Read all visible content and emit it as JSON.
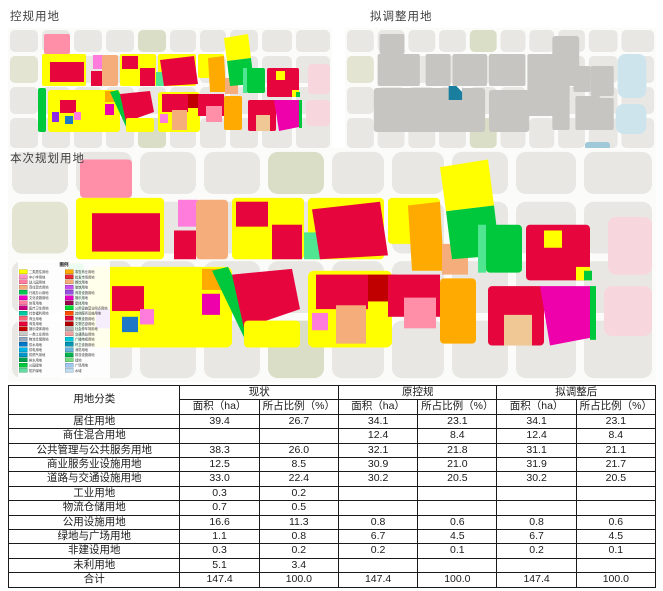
{
  "maps": {
    "control_plan": {
      "title": "控规用地"
    },
    "proposed_adjust": {
      "title": "拟调整用地"
    },
    "current_plan": {
      "title": "本次规划用地"
    }
  },
  "palette": {
    "yellow": "#ffff00",
    "red": "#e6053c",
    "darkred": "#c00000",
    "green": "#00c83c",
    "mint": "#50e691",
    "orange": "#ffaa00",
    "salmon": "#f5ae7b",
    "pink": "#ff8fa8",
    "magenta": "#ee00aa",
    "brightpink": "#ff7bdc",
    "violet": "#8c28e6",
    "blue": "#1e78c8",
    "teal": "#1a7f9e",
    "tan": "#f0c896",
    "palepink": "#f8d6de",
    "grayblock": "#e8e7e4",
    "olive": "#dbdec6",
    "olivelight": "#e3e4d2",
    "darkgray": "#c6c5c1",
    "water": "#cde4ec",
    "darkwater": "#9fc8d8",
    "street": "#fbfbf9"
  },
  "legend": {
    "title": "图例",
    "columns": [
      [
        {
          "color": "#ffff00",
          "label": "二类居住用地"
        },
        {
          "color": "#ff96c8",
          "label": "中小学用地"
        },
        {
          "color": "#ff7da0",
          "label": "幼儿园用地"
        },
        {
          "color": "#f5ae7b",
          "label": "商住混合用地"
        },
        {
          "color": "#00c850",
          "label": "行政办公用地"
        },
        {
          "color": "#f000c8",
          "label": "文化设施用地"
        },
        {
          "color": "#ff7da0",
          "label": "体育用地"
        },
        {
          "color": "#c80082",
          "label": "医疗卫生用地"
        },
        {
          "color": "#00c8a0",
          "label": "社会福利用地"
        },
        {
          "color": "#ff6478",
          "label": "商业用地"
        },
        {
          "color": "#e6003c",
          "label": "商务用地"
        },
        {
          "color": "#c80000",
          "label": "娱乐康体用地"
        },
        {
          "color": "#c8c8c8",
          "label": "一类工业用地"
        },
        {
          "color": "#96aabe",
          "label": "物流仓储用地"
        },
        {
          "color": "#0078c8",
          "label": "供水用地"
        },
        {
          "color": "#00b4e6",
          "label": "供电用地"
        },
        {
          "color": "#0096c8",
          "label": "供燃气用地"
        },
        {
          "color": "#00a050",
          "label": "排水用地"
        },
        {
          "color": "#00c83c",
          "label": "公园绿地"
        },
        {
          "color": "#64dca0",
          "label": "防护绿地"
        }
      ],
      [
        {
          "color": "#ffaa00",
          "label": "零售商业用地"
        },
        {
          "color": "#e62839",
          "label": "批发市场用地"
        },
        {
          "color": "#f5ae7b",
          "label": "餐饮用地"
        },
        {
          "color": "#c850f0",
          "label": "旅馆用地"
        },
        {
          "color": "#9650e6",
          "label": "商务设施用地"
        },
        {
          "color": "#e600c8",
          "label": "娱乐用地"
        },
        {
          "color": "#a00050",
          "label": "康体用地"
        },
        {
          "color": "#00dc32",
          "label": "公用设施营业网点用地"
        },
        {
          "color": "#ff5000",
          "label": "其他服务设施用地"
        },
        {
          "color": "#e6003c",
          "label": "宗教设施用地"
        },
        {
          "color": "#b40000",
          "label": "文物古迹用地"
        },
        {
          "color": "#b4b4b4",
          "label": "社会停车场用地"
        },
        {
          "color": "#f0a0a0",
          "label": "交通场站用地"
        },
        {
          "color": "#00c8dc",
          "label": "广播电视用地"
        },
        {
          "color": "#0096b4",
          "label": "环卫设施用地"
        },
        {
          "color": "#64b4dc",
          "label": "消防用地"
        },
        {
          "color": "#00b450",
          "label": "排涝设施用地"
        },
        {
          "color": "#78dc82",
          "label": "绿地"
        },
        {
          "color": "#a0c8f0",
          "label": "广场用地"
        },
        {
          "color": "#bedcf0",
          "label": "水域"
        }
      ]
    ]
  },
  "table": {
    "corner": "用地分类",
    "groups": [
      {
        "label": "现状"
      },
      {
        "label": "原控规"
      },
      {
        "label": "拟调整后"
      }
    ],
    "subheaders": [
      "面积（ha）",
      "所占比例（%）"
    ],
    "rows": [
      {
        "category": "居住用地",
        "values": [
          "39.4",
          "26.7",
          "34.1",
          "23.1",
          "34.1",
          "23.1"
        ]
      },
      {
        "category": "商住混合用地",
        "values": [
          "",
          "",
          "12.4",
          "8.4",
          "12.4",
          "8.4"
        ]
      },
      {
        "category": "公共管理与公共服务用地",
        "values": [
          "38.3",
          "26.0",
          "32.1",
          "21.8",
          "31.1",
          "21.1"
        ]
      },
      {
        "category": "商业服务业设施用地",
        "values": [
          "12.5",
          "8.5",
          "30.9",
          "21.0",
          "31.9",
          "21.7"
        ]
      },
      {
        "category": "道路与交通设施用地",
        "values": [
          "33.0",
          "22.4",
          "30.2",
          "20.5",
          "30.2",
          "20.5"
        ]
      },
      {
        "category": "工业用地",
        "values": [
          "0.3",
          "0.2",
          "",
          "",
          "",
          ""
        ]
      },
      {
        "category": "物流仓储用地",
        "values": [
          "0.7",
          "0.5",
          "",
          "",
          "",
          ""
        ]
      },
      {
        "category": "公用设施用地",
        "values": [
          "16.6",
          "11.3",
          "0.8",
          "0.6",
          "0.8",
          "0.6"
        ]
      },
      {
        "category": "绿地与广场用地",
        "values": [
          "1.1",
          "0.8",
          "6.7",
          "4.5",
          "6.7",
          "4.5"
        ]
      },
      {
        "category": "非建设用地",
        "values": [
          "0.3",
          "0.2",
          "0.2",
          "0.1",
          "0.2",
          "0.1"
        ]
      },
      {
        "category": "未利用地",
        "values": [
          "5.1",
          "3.4",
          "",
          "",
          "",
          ""
        ]
      },
      {
        "category": "合计",
        "values": [
          "147.4",
          "100.0",
          "147.4",
          "100.0",
          "147.4",
          "100.0"
        ]
      }
    ]
  }
}
